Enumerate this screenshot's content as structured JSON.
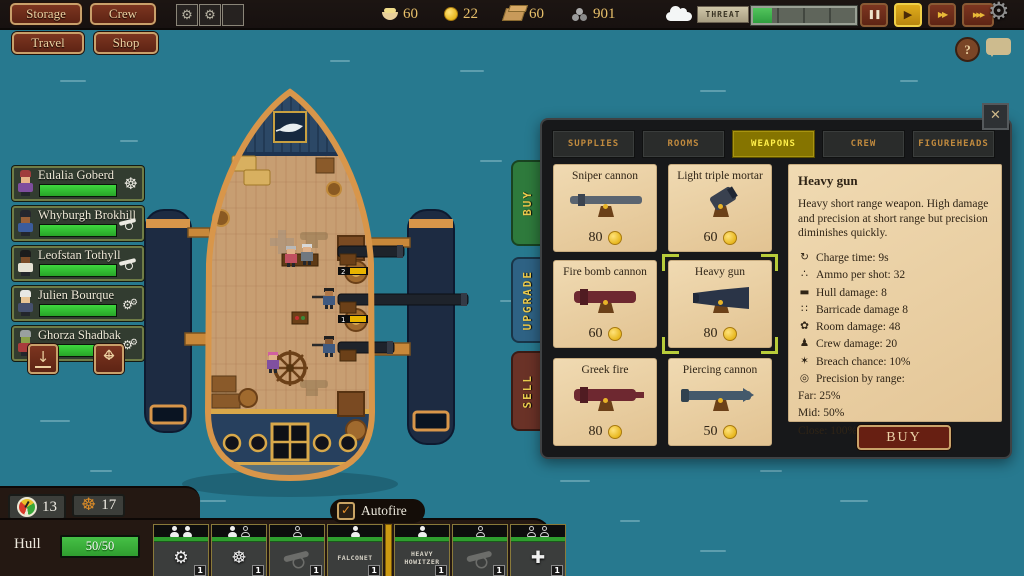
{
  "topbar": {
    "storage_label": "Storage",
    "crew_label": "Crew",
    "travel_label": "Travel",
    "shop_label": "Shop",
    "resources": [
      {
        "icon": "food-icon",
        "value": "60"
      },
      {
        "icon": "gold-icon",
        "value": "22"
      },
      {
        "icon": "wood-icon",
        "value": "60"
      },
      {
        "icon": "cannonball-icon",
        "value": "901"
      }
    ],
    "threat": {
      "label": "THREAT",
      "fill_percent": 19
    },
    "playback": [
      {
        "name": "pause-button",
        "glyph": "❚❚",
        "cls": "pb-pause",
        "active": false
      },
      {
        "name": "play-button",
        "glyph": "▶",
        "cls": "pb-play",
        "active": true
      },
      {
        "name": "fast-forward-button",
        "glyph": "▶▶",
        "cls": "pb-ff",
        "active": false
      },
      {
        "name": "fastest-forward-button",
        "glyph": "▶▶▶",
        "cls": "pb-fff",
        "active": false
      }
    ],
    "gear_glyph": "⚙",
    "help_label": "?"
  },
  "crew_panel": {
    "members": [
      {
        "name": "Eulalia Goberd",
        "role": "helm",
        "health_percent": 100,
        "avatar": {
          "hat": "#a03c3c",
          "skin": "#e8b488",
          "shirt": "#7e4e9e"
        }
      },
      {
        "name": "Whyburgh Brokhill",
        "role": "cannon",
        "health_percent": 100,
        "avatar": {
          "hat": "#26262e",
          "skin": "#9a6038",
          "shirt": "#3c5c9c"
        }
      },
      {
        "name": "Leofstan Tothyll",
        "role": "cannon",
        "health_percent": 100,
        "avatar": {
          "hat": "#1c1c1c",
          "skin": "#7c4c28",
          "shirt": "#e6e2d4"
        }
      },
      {
        "name": "Julien Bourque",
        "role": "gears",
        "health_percent": 100,
        "avatar": {
          "hat": "#e8e8e4",
          "skin": "#e8c494",
          "shirt": "#46506e"
        }
      },
      {
        "name": "Ghorza Shadbak",
        "role": "gears",
        "health_percent": 100,
        "avatar": {
          "hat": "#9aa0a0",
          "skin": "#8aa048",
          "shirt": "#a83c3c"
        }
      }
    ]
  },
  "shop": {
    "close_glyph": "✕",
    "tabs": [
      {
        "label": "Supplies",
        "active": false
      },
      {
        "label": "Rooms",
        "active": false
      },
      {
        "label": "Weapons",
        "active": true
      },
      {
        "label": "Crew",
        "active": false
      },
      {
        "label": "FigureHeads",
        "active": false
      }
    ],
    "side_tabs": [
      {
        "label": "Buy",
        "color": "#2e7a3c"
      },
      {
        "label": "Upgrade",
        "color": "#2e6284"
      },
      {
        "label": "Sell",
        "color": "#6a3227"
      }
    ],
    "items": [
      {
        "name": "Sniper cannon",
        "price": "80",
        "style": "sniper",
        "selected": false
      },
      {
        "name": "Light triple mortar",
        "price": "60",
        "style": "mortar",
        "selected": false
      },
      {
        "name": "Fire bomb cannon",
        "price": "60",
        "style": "firebomb",
        "selected": false
      },
      {
        "name": "Heavy gun",
        "price": "80",
        "style": "heavy",
        "selected": true
      },
      {
        "name": "Greek fire",
        "price": "80",
        "style": "greek",
        "selected": false
      },
      {
        "name": "Piercing cannon",
        "price": "50",
        "style": "piercing",
        "selected": false
      }
    ],
    "detail": {
      "title": "Heavy gun",
      "description": "Heavy short range weapon. High damage and precision at short range but precision diminishes quickly.",
      "stats": [
        {
          "icon": "↻",
          "icon_name": "charge-time-icon",
          "text": "Charge time: 9s"
        },
        {
          "icon": "∴",
          "icon_name": "ammo-icon",
          "text": "Ammo per shot: 32"
        },
        {
          "icon": "▬",
          "icon_name": "hull-damage-icon",
          "text": "Hull damage: 8"
        },
        {
          "icon": "∷",
          "icon_name": "barricade-damage-icon",
          "text": "Barricade damage 8"
        },
        {
          "icon": "✿",
          "icon_name": "room-damage-icon",
          "text": "Room damage: 48"
        },
        {
          "icon": "♟",
          "icon_name": "crew-damage-icon",
          "text": "Crew damage: 20"
        },
        {
          "icon": "✶",
          "icon_name": "breach-chance-icon",
          "text": "Breach chance: 10%"
        },
        {
          "icon": "◎",
          "icon_name": "precision-icon",
          "text": "Precision by range:"
        },
        {
          "icon": "",
          "icon_name": "",
          "text": "Far: 25%"
        },
        {
          "icon": "",
          "icon_name": "",
          "text": "Mid: 50%"
        },
        {
          "icon": "",
          "icon_name": "",
          "text": "Close: 100%"
        }
      ],
      "buy_label": "BUY"
    }
  },
  "hud": {
    "speed": "13",
    "helm": "17",
    "hull_label": "Hull",
    "hull_value": "50/50",
    "autofire_label": "Autofire",
    "autofire_checked": true,
    "check_glyph": "✓",
    "slots": [
      {
        "crew": [
          "filled",
          "filled"
        ],
        "icon": "gears",
        "count": "1"
      },
      {
        "crew": [
          "filled",
          "empty"
        ],
        "icon": "wheel",
        "count": "1"
      },
      {
        "crew": [
          "empty"
        ],
        "icon": "ghost-cannon",
        "count": "1"
      },
      {
        "crew": [
          "filled"
        ],
        "label": "FALCONET",
        "count": "1"
      },
      {
        "crew": [
          "filled"
        ],
        "label": "HEAVY HOWITZER",
        "count": "1",
        "separator_before": true
      },
      {
        "crew": [
          "empty"
        ],
        "icon": "ghost-cannon",
        "count": "1"
      },
      {
        "crew": [
          "empty",
          "empty"
        ],
        "icon": "medic",
        "count": "1"
      }
    ]
  }
}
